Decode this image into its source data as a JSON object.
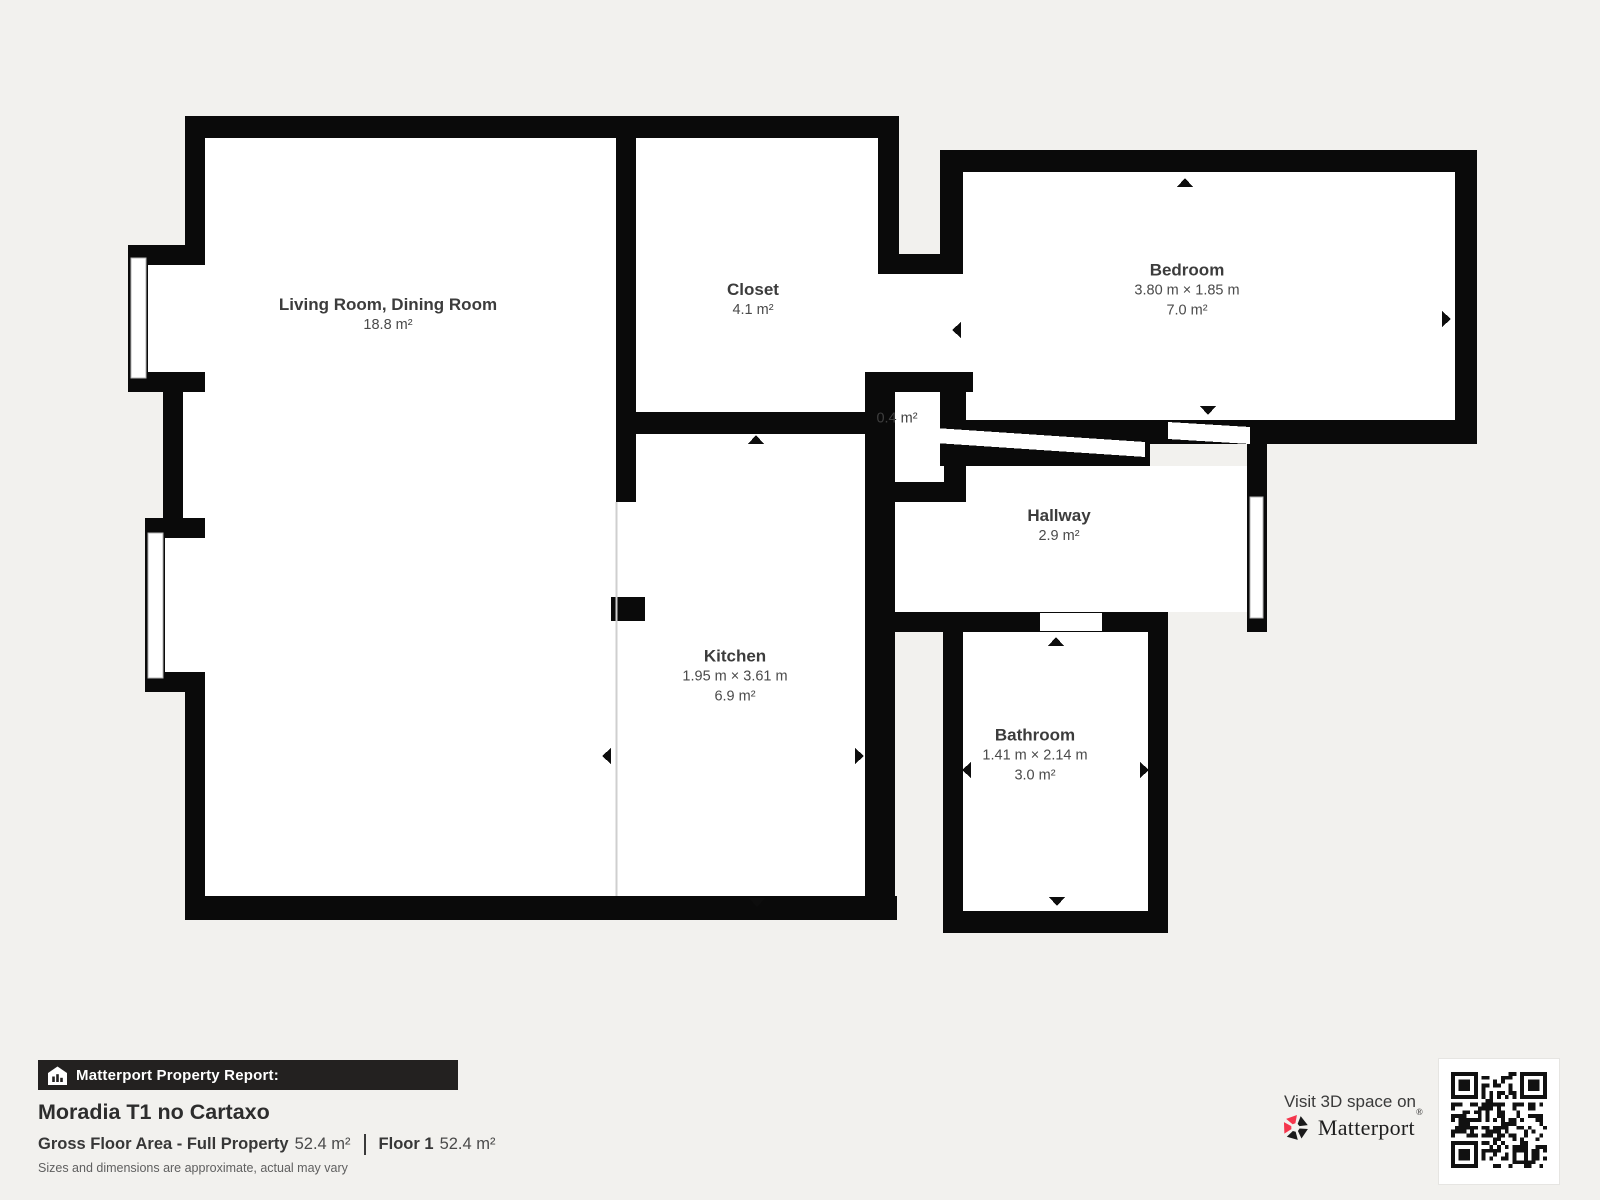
{
  "plan": {
    "rooms": {
      "living": {
        "name": "Living Room, Dining Room",
        "area": "18.8 m²"
      },
      "closet": {
        "name": "Closet",
        "area": "4.1 m²"
      },
      "bedroom": {
        "name": "Bedroom",
        "dims": "3.80 m × 1.85 m",
        "area": "7.0 m²"
      },
      "nook": {
        "area": "0.4 m²"
      },
      "hallway": {
        "name": "Hallway",
        "area": "2.9 m²"
      },
      "kitchen": {
        "name": "Kitchen",
        "dims": "1.95 m × 3.61 m",
        "area": "6.9 m²"
      },
      "bathroom": {
        "name": "Bathroom",
        "dims": "1.41 m × 2.14 m",
        "area": "3.0 m²"
      }
    }
  },
  "footer": {
    "report_label": "Matterport Property Report:",
    "property_name": "Moradia T1 no Cartaxo",
    "gross_area_label": "Gross Floor Area - Full Property",
    "gross_area_value": "52.4 m²",
    "floor_label": "Floor 1",
    "floor_value": "52.4 m²",
    "disclaimer": "Sizes and dimensions are approximate, actual may vary"
  },
  "cta": {
    "visit_label": "Visit 3D space on",
    "brand_name": "Matterport",
    "brand_mark": "®"
  },
  "icons": {
    "report_icon": "house-with-chart-bars",
    "brand_icon": "matterport-pinwheel",
    "qr_icon": "qr-code"
  },
  "colors": {
    "background": "#f2f1ee",
    "wall": "#0a0a0a",
    "report_bar": "#232120",
    "brand_red": "#f4364c",
    "text": "#3d3d3d"
  }
}
